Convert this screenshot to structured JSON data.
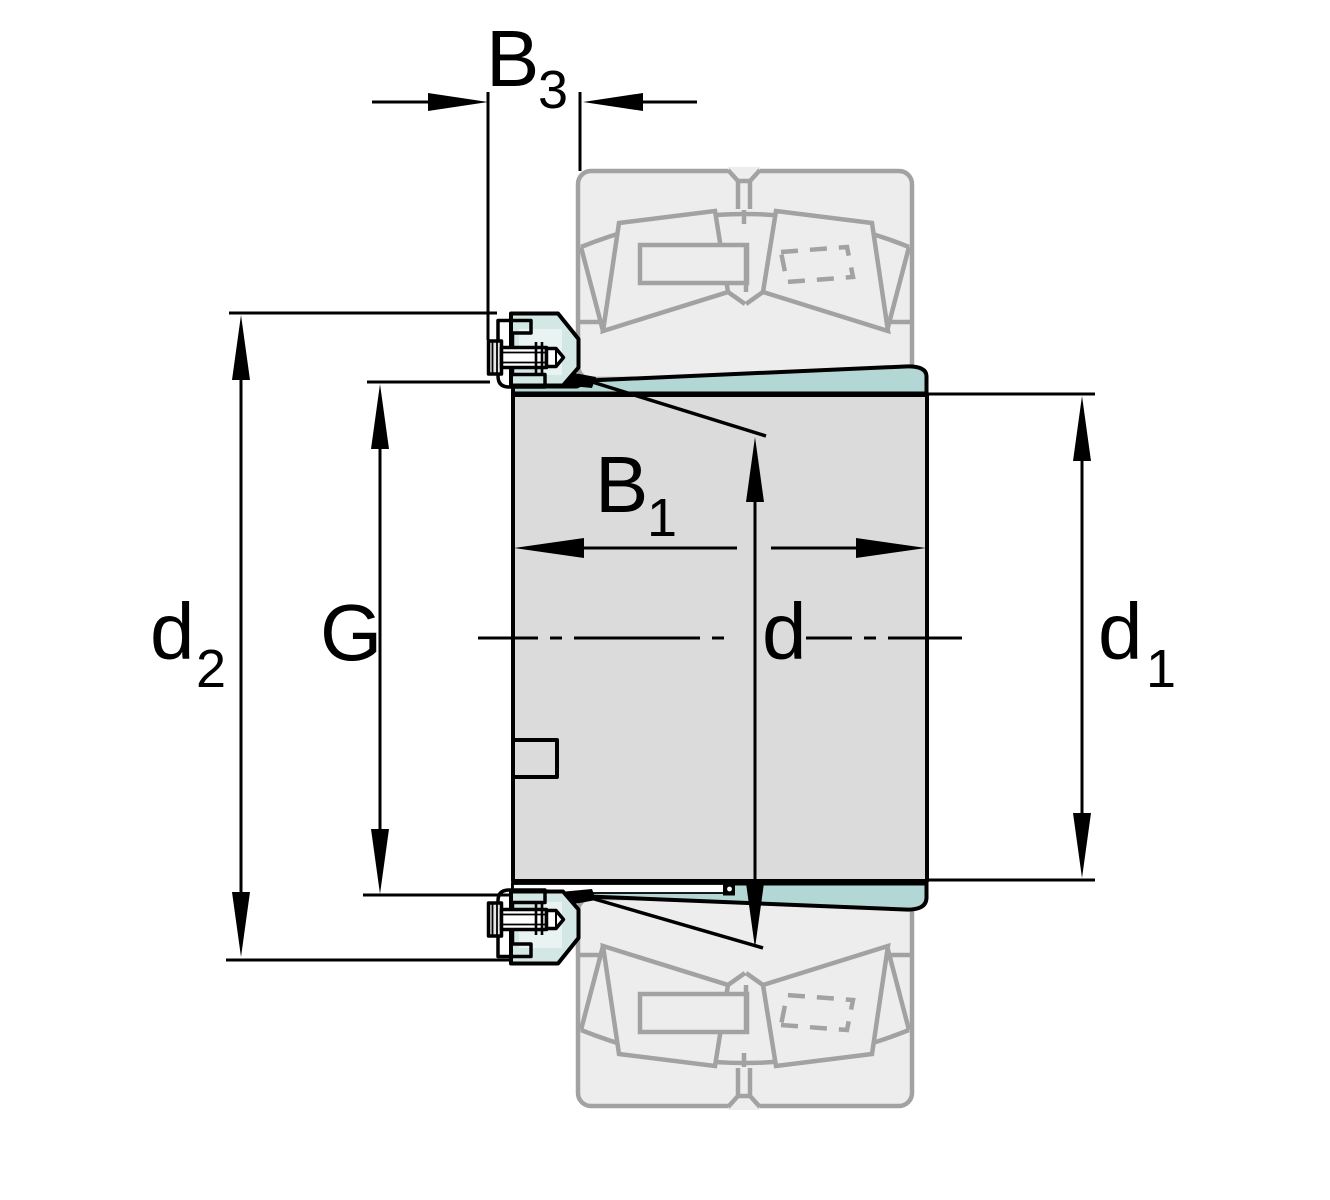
{
  "figure": {
    "kind": "technical-dimension-drawing",
    "subject": "adapter sleeve with lock nut and locking screw, shown with spherical roller bearing in section"
  },
  "labels": {
    "b3": {
      "main": "B",
      "sub": "3"
    },
    "b1": {
      "main": "B",
      "sub": "1"
    },
    "d2": {
      "main": "d",
      "sub": "2"
    },
    "g": {
      "main": "G",
      "sub": ""
    },
    "d": {
      "main": "d",
      "sub": ""
    },
    "d1": {
      "main": "d",
      "sub": "1"
    }
  },
  "colors": {
    "sleeve_teal": "#b2d7d4",
    "nut_teal": "#d3e7e4",
    "nut_highlight": "#e9f3f1",
    "ghost_fill": "#ededed",
    "ghost_stroke": "#a2a2a2",
    "body_gray": "#dbdbdb",
    "line": "#000000",
    "background": "#ffffff"
  }
}
